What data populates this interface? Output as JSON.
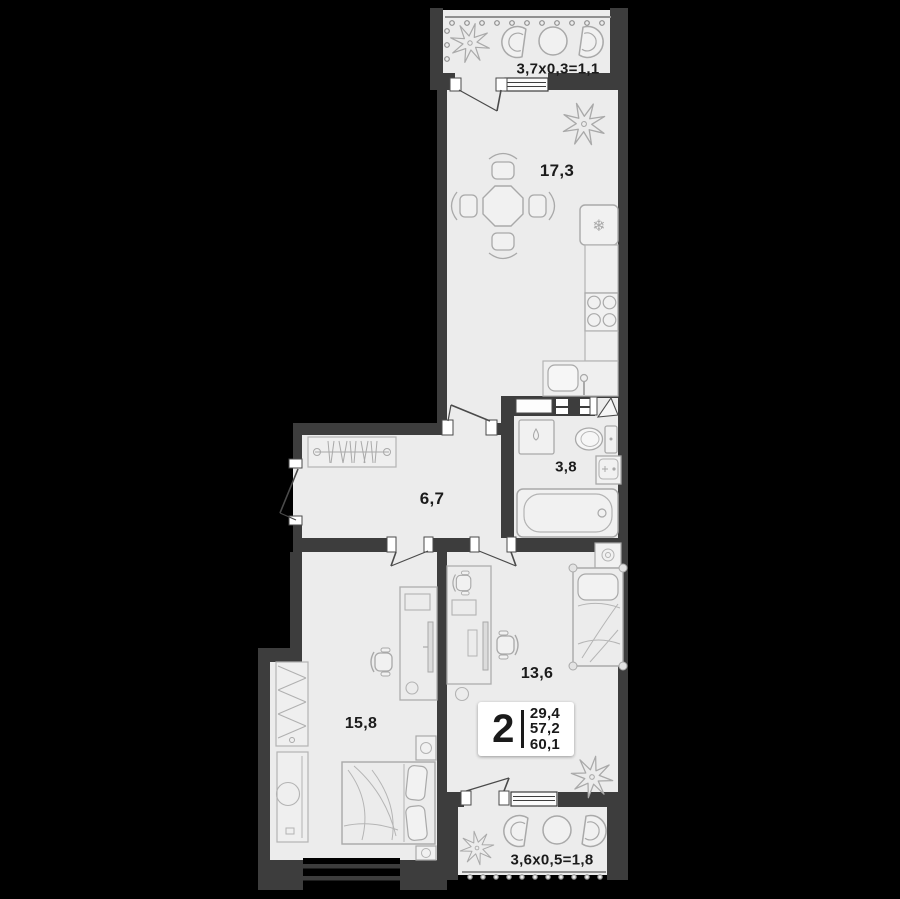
{
  "colors": {
    "background": "#000000",
    "wall": "#3d3d3d",
    "floor": "#ececec",
    "furniture_stroke": "#a9a9a9",
    "text": "#1b1b1b",
    "badge_background": "#ffffff"
  },
  "rooms": {
    "kitchen_living": {
      "area": "17,3"
    },
    "hallway": {
      "area": "6,7"
    },
    "bathroom": {
      "area": "3,8"
    },
    "bedroom": {
      "area": "15,8"
    },
    "bedroom2": {
      "area": "13,6"
    }
  },
  "balconies": {
    "top": {
      "dimensions": "3,7x0,3=1,1"
    },
    "bottom": {
      "dimensions": "3,6x0,5=1,8"
    }
  },
  "info_badge": {
    "room_count": "2",
    "living_area": "29,4",
    "apartment_area": "57,2",
    "total_area": "60,1"
  },
  "icons": {
    "snowflake_glyph": "❄"
  }
}
